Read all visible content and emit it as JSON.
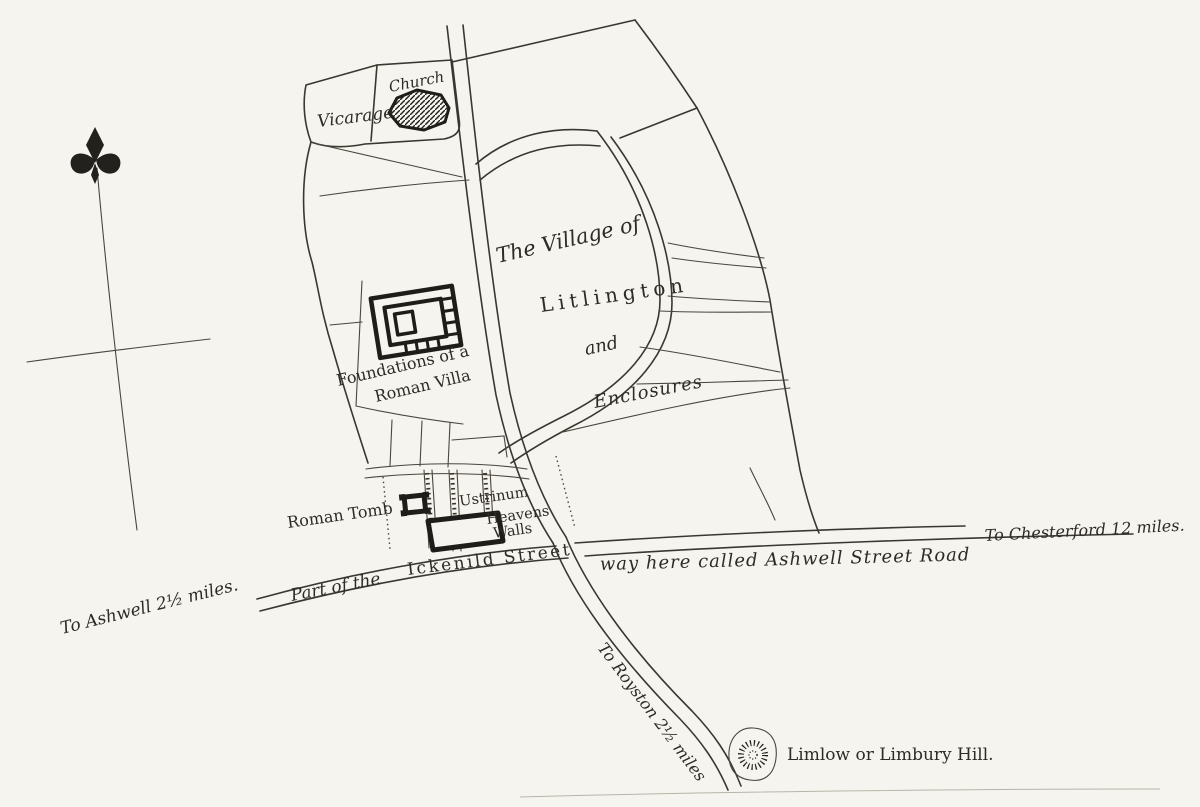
{
  "map": {
    "title": "Plan of the Village of Litlington and Enclosures",
    "colors": {
      "paper": "#f6f4ef",
      "ink": "#3a372f",
      "heavy_ink": "#1f1d19"
    },
    "labels": {
      "vicarage": "Vicarage",
      "church": "Church",
      "village_of": "The Village of",
      "village_name": "Litlington",
      "village_and": "and",
      "village_enclosures": "Enclosures",
      "villa_line1": "Foundations of a",
      "villa_line2": "Roman Villa",
      "roman_tomb": "Roman Tomb",
      "ustrinum": "Ustrinum",
      "heavens": "Heavens",
      "walls": "Walls",
      "ickenild_part1": "Part of the",
      "ickenild_part2": "Ickenild Street",
      "ashwell_way": "way here called Ashwell Street Road",
      "to_chesterford": "To Chesterford 12 miles.",
      "to_ashwell": "To Ashwell 2½ miles.",
      "to_royston": "To Royston 2½ miles",
      "limlow": "Limlow or Limbury Hill."
    }
  }
}
